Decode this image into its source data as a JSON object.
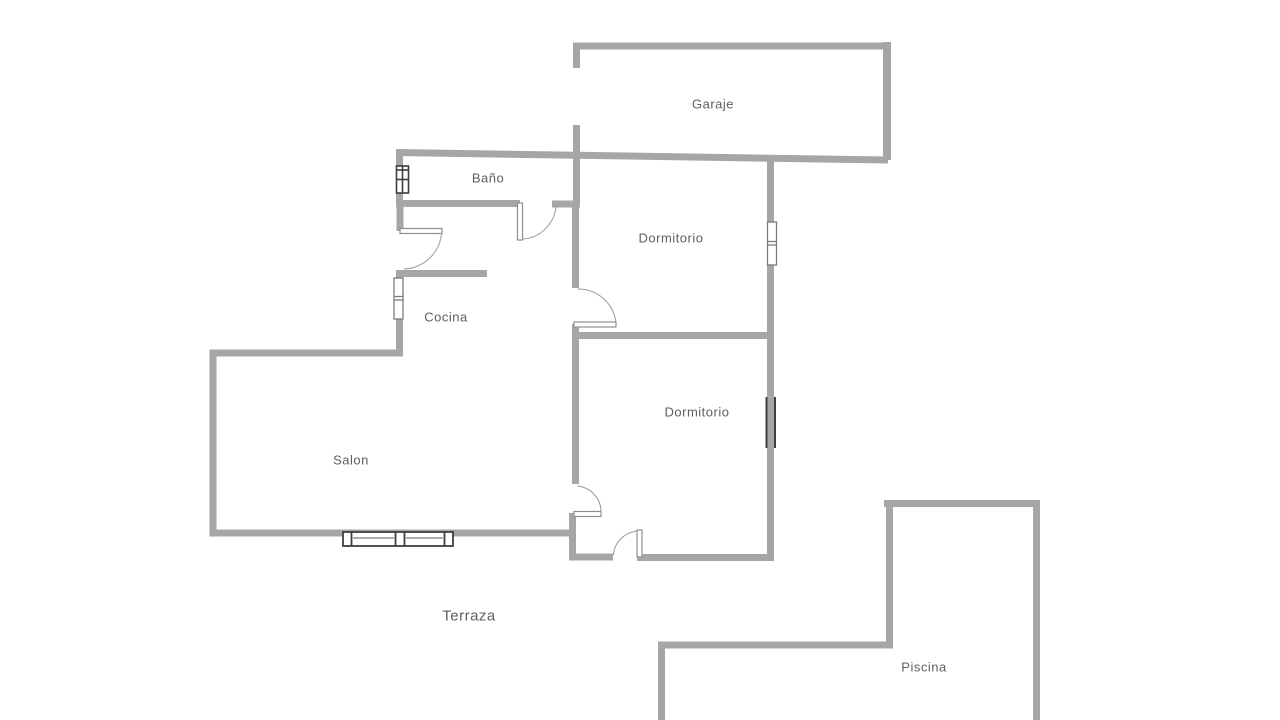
{
  "colors": {
    "wall": "#a6a6a6",
    "label": "#5f5f5f",
    "door": "#8f8f8f",
    "arc": "#9a9a9a",
    "window_dark": "#3f3f3f",
    "window_light": "#7c7c7c",
    "background": "#ffffff"
  },
  "floorplan": {
    "type": "residential-floor-plan",
    "rooms": [
      {
        "id": "garaje",
        "label": "Garaje"
      },
      {
        "id": "bano",
        "label": "Baño"
      },
      {
        "id": "dormitorio-1",
        "label": "Dormitorio"
      },
      {
        "id": "cocina",
        "label": "Cocina"
      },
      {
        "id": "dormitorio-2",
        "label": "Dormitorio"
      },
      {
        "id": "salon",
        "label": "Salon"
      },
      {
        "id": "terraza",
        "label": "Terraza"
      },
      {
        "id": "piscina",
        "label": "Piscina"
      }
    ],
    "features": {
      "doors": [
        "bano-door",
        "cocina-door",
        "dormitorio-1-door",
        "dormitorio-2-door",
        "terraza-door"
      ],
      "windows": [
        "bano-window",
        "cocina-window",
        "dormitorio-1-window",
        "dormitorio-2-glass",
        "salon-sliding-window"
      ]
    }
  }
}
